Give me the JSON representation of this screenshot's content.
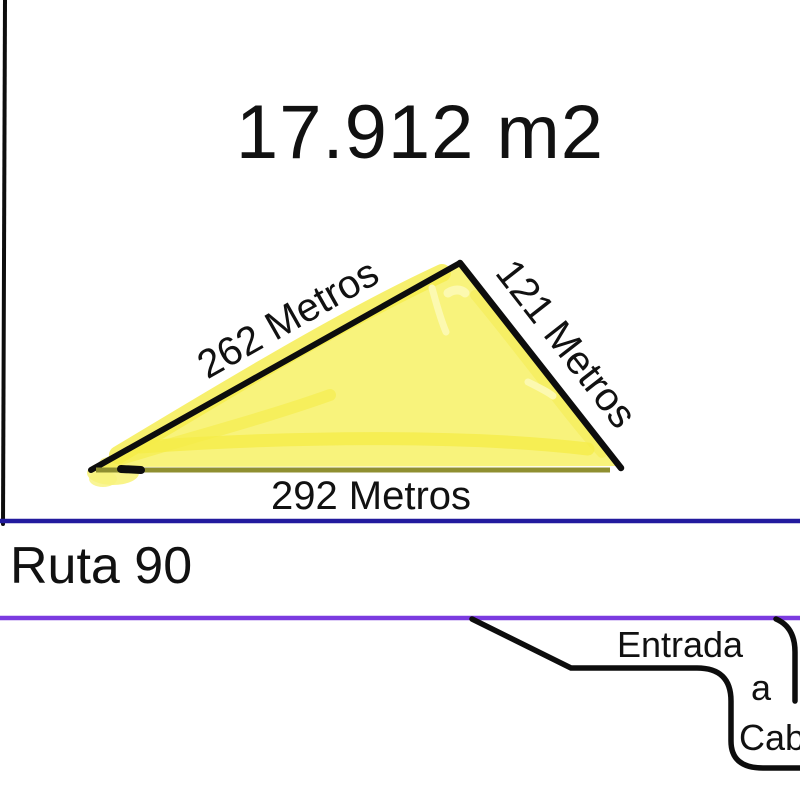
{
  "colors": {
    "ink": "#0d0d0d",
    "navy_road_line": "#221a9e",
    "purple_road_line": "#7b3be0",
    "plot_fill": "#f8f37c",
    "plot_fill_dark": "#f5ec48",
    "plot_fill_light": "#fcf9b0",
    "plot_bottom_edge": "#8f8f30",
    "text": "#111111"
  },
  "plot": {
    "area_label": "17.912 m2",
    "side_left_label": "262 Metros",
    "side_right_label": "121 Metros",
    "side_bottom_label": "292 Metros"
  },
  "road": {
    "name_label": "Ruta 90"
  },
  "entrance": {
    "line1": "Entrada",
    "line2": "a",
    "line3": "Cab"
  }
}
